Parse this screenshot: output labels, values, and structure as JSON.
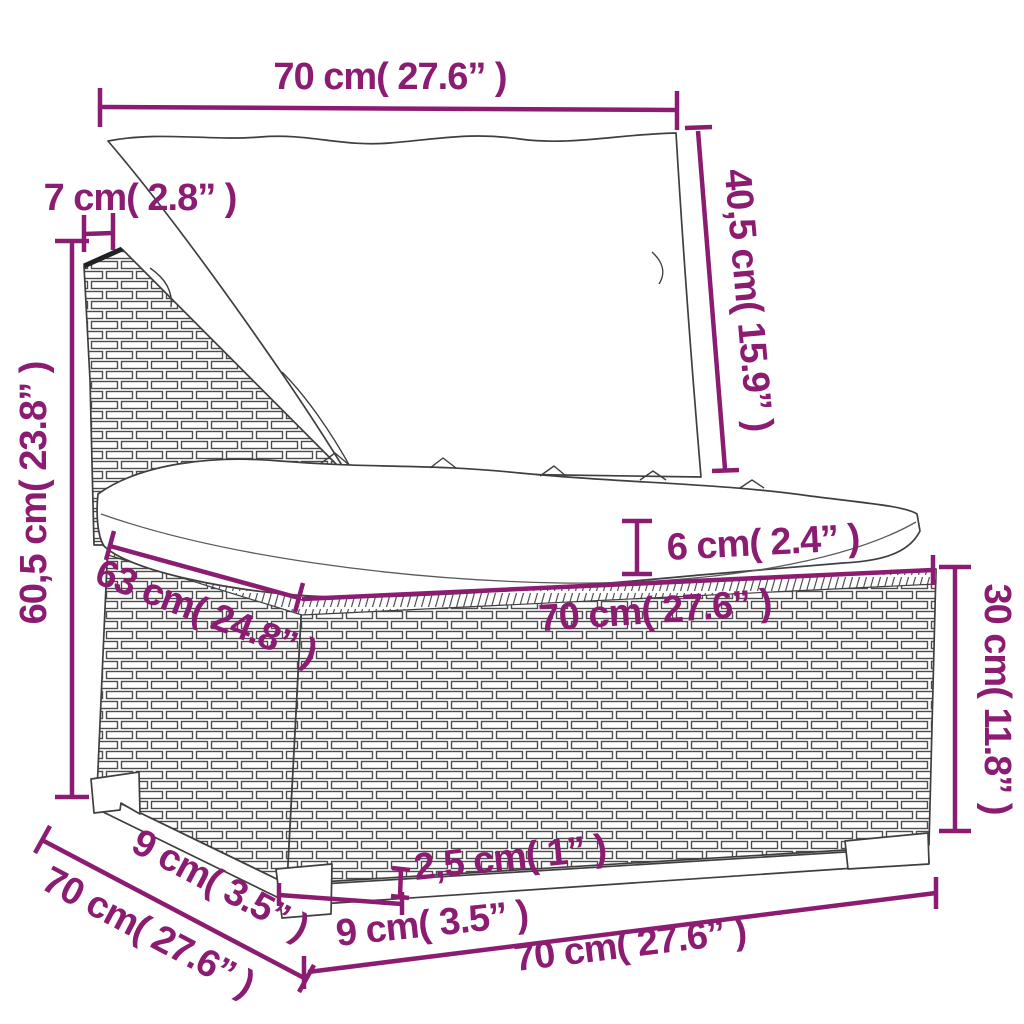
{
  "diagram": {
    "description": "Poly rattan garden sofa middle section with cushions - dimension drawing",
    "colors": {
      "dimension_annotation": "#8B1C72",
      "line_art": "#3F3F3F",
      "background": "#FFFFFF"
    },
    "dimensions": {
      "back_cushion_width": "70 cm( 27.6” )",
      "back_frame_thickness": "7 cm( 2.8” )",
      "total_height": "60,5 cm( 23.8” )",
      "back_cushion_height": "40,5 cm( 15.9” )",
      "seat_cushion_thickness": "6 cm( 2.4” )",
      "seat_depth": "63 cm( 24.8” )",
      "seat_width": "70 cm( 27.6” )",
      "base_height": "30 cm( 11.8” )",
      "ground_clearance": "2,5 cm( 1” )",
      "front_leg_width": "9 cm( 3.5” )",
      "side_leg_width": "9 cm( 3.5” )",
      "base_depth": "70 cm( 27.6” )",
      "base_width": "70 cm( 27.6” )"
    }
  }
}
